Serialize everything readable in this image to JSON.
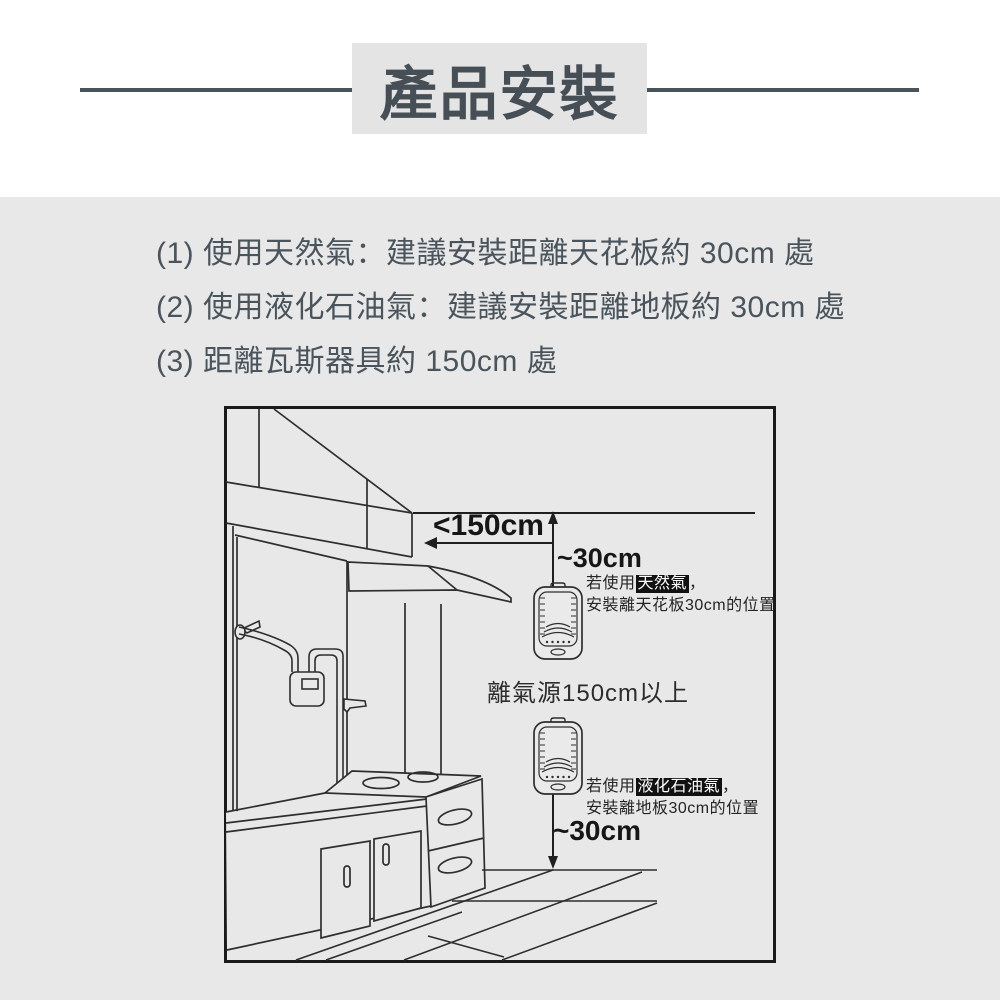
{
  "header": {
    "title": "產品安裝"
  },
  "instructions": {
    "items": [
      "(1) 使用天然氣：建議安裝距離天花板約 30cm 處",
      "(2) 使用液化石油氣：建議安裝距離地板約 30cm 處",
      "(3) 距離瓦斯器具約 150cm 處"
    ]
  },
  "diagram": {
    "ceiling_distance_label": "<150cm",
    "top_distance_label": "~30cm",
    "bottom_distance_label": "~30cm",
    "gas_source_label": "離氣源150cm以上",
    "natural_gas_note": {
      "prefix": "若使用",
      "highlight": "天然氣",
      "suffix": "，",
      "line2": "安裝離天花板30cm的位置"
    },
    "lpg_note": {
      "prefix": "若使用",
      "highlight": "液化石油氣",
      "suffix": "，",
      "line2": "安裝離地板30cm的位置"
    }
  },
  "colors": {
    "section_bg": "#e8e8e8",
    "header_text": "#474f56",
    "body_text": "#4a545c",
    "line_art": "#2e2e2e",
    "highlight_bg": "#111111",
    "highlight_text": "#ffffff"
  }
}
